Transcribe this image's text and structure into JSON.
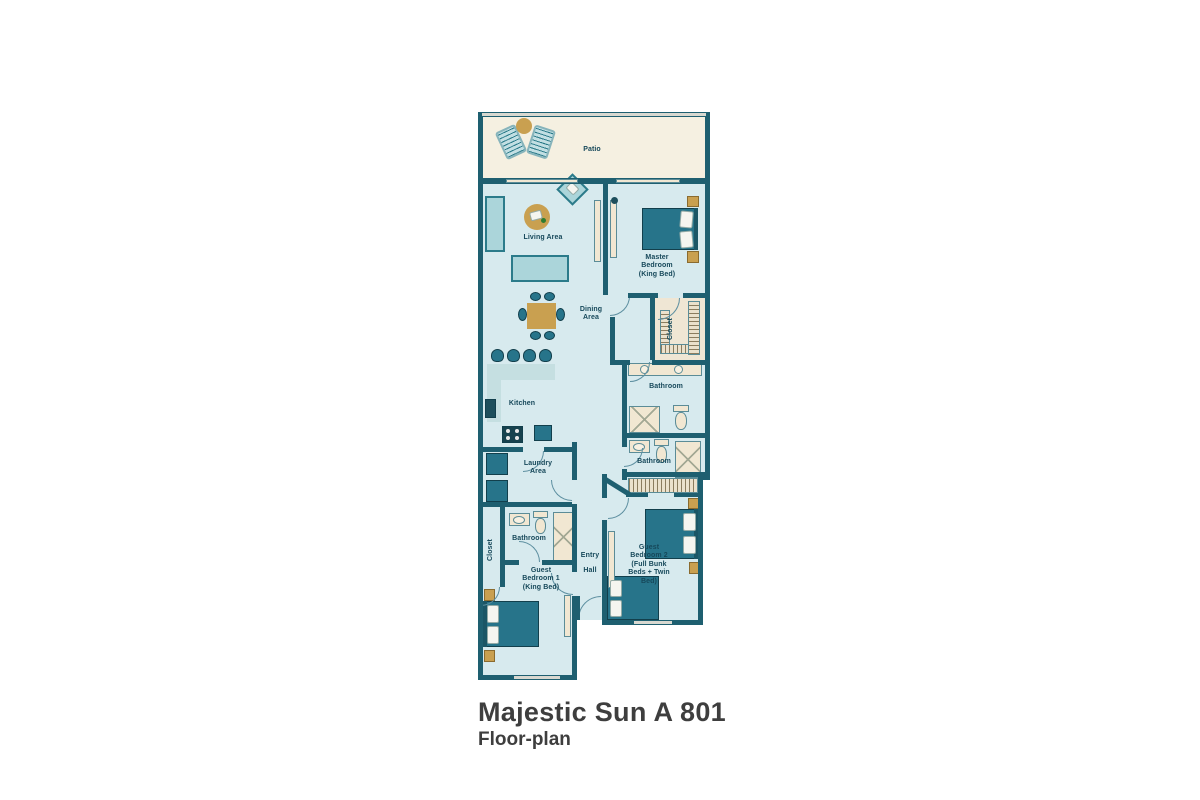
{
  "title": {
    "heading": "Majestic Sun A 801",
    "subheading": "Floor-plan"
  },
  "rooms": {
    "patio": {
      "label": "Patio"
    },
    "living": {
      "label": "Living Area"
    },
    "dining": {
      "label": "Dining Area"
    },
    "kitchen": {
      "label": "Kitchen"
    },
    "laundry": {
      "label": "Laundry Area"
    },
    "master": {
      "label": "Master Bedroom (King Bed)"
    },
    "master_closet": {
      "label": "Closet"
    },
    "master_bath": {
      "label": "Bathroom"
    },
    "hall_bath": {
      "label": "Bathroom"
    },
    "guest1_bath": {
      "label": "Bathroom"
    },
    "guest1_closet": {
      "label": "Closet"
    },
    "guest1": {
      "label": "Guest Bedroom 1 (King Bed)"
    },
    "guest2": {
      "label": "Guest Bedroom 2 (Full Bunk Beds + Twin Bed)"
    },
    "entry": {
      "label": "Entry Hall"
    }
  },
  "colors": {
    "wall": "#1e5f70",
    "floor": "#d7eaee",
    "patio_floor": "#f5f0e1",
    "fixture_cream": "#f1e7d2",
    "furniture_dark": "#27748a",
    "furniture_light": "#abd5da",
    "accent_tan": "#c9a050",
    "label_text": "#16485a",
    "title_text": "#3e3e3e"
  }
}
